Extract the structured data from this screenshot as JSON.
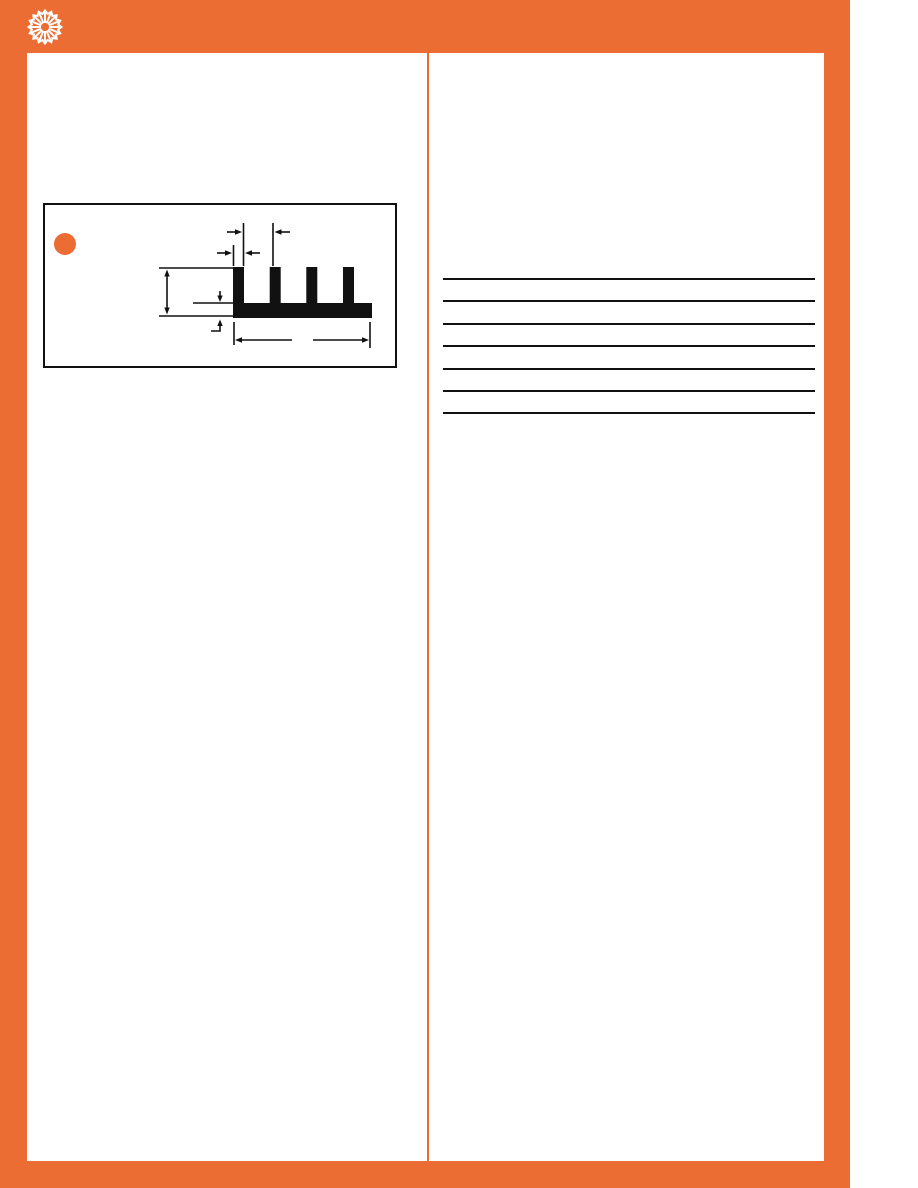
{
  "page": {
    "type": "catalog-datasheet-page",
    "background_color": "#ffffff",
    "accent_color": "#EB6D34",
    "ink_color": "#111111"
  },
  "header": {
    "logo_icon": "starburst-arrows-icon",
    "logo_color": "#ffffff"
  },
  "figure": {
    "marker_icon": "orange-dot-bullet",
    "marker_color": "#EB6D34",
    "subject": "finned-heatsink-extrusion-cross-section",
    "fin_count": 4,
    "dimensions_indicated": [
      "fin-spacing",
      "fin-width",
      "overall-height",
      "base-thickness",
      "overall-width"
    ],
    "dimension_values_printed": false
  },
  "spec_table": {
    "rule_count": 7,
    "row_count": 6,
    "cells_empty": true
  }
}
